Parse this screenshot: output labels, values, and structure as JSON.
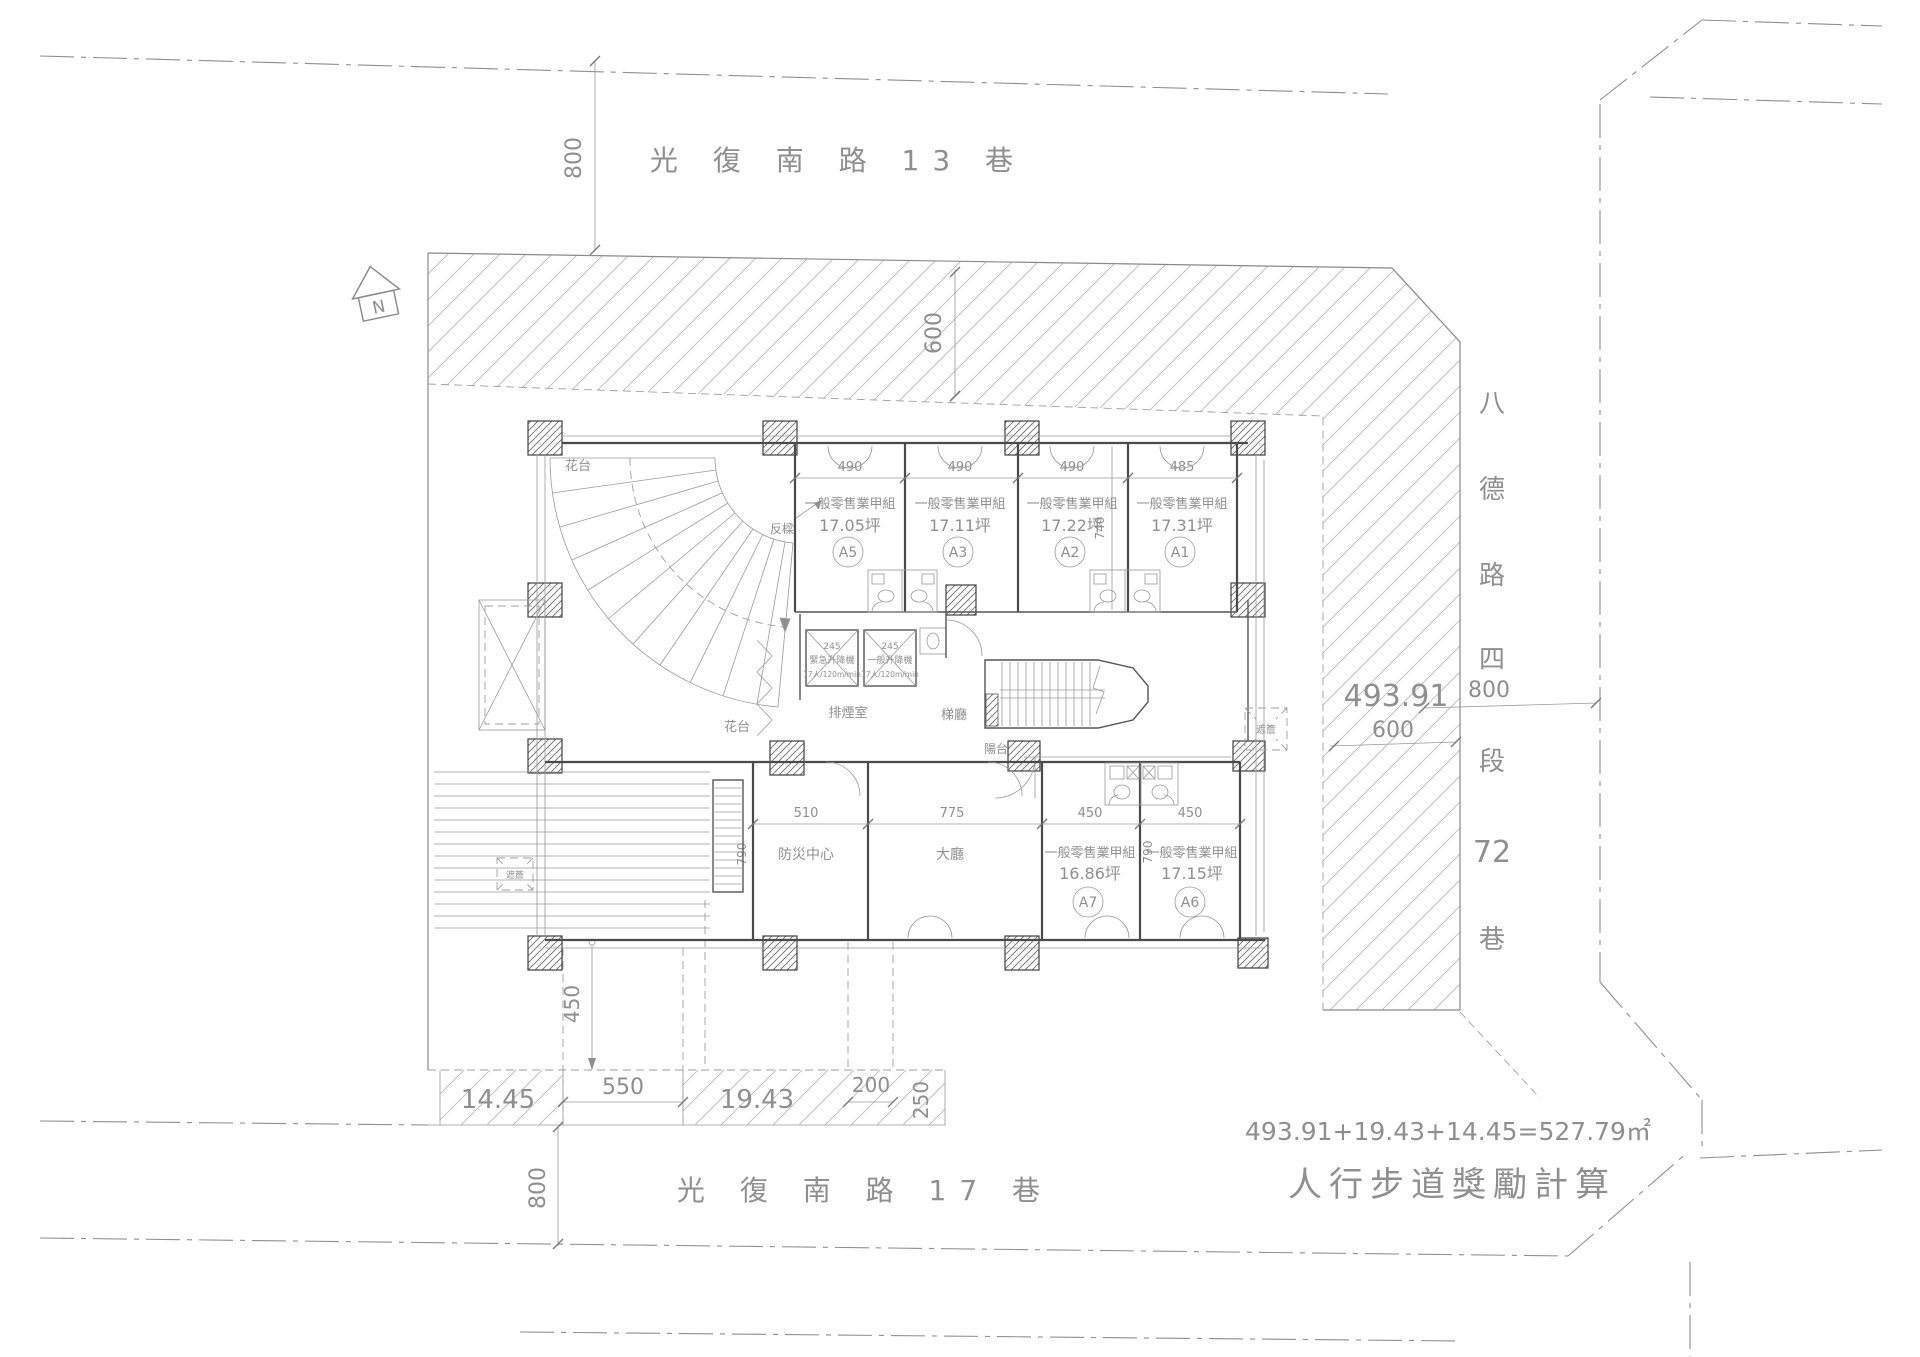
{
  "north": {
    "label": "N"
  },
  "streets": {
    "top": {
      "name": "光 復 南 路 13 巷",
      "width_dim": "800"
    },
    "bottom": {
      "name": "光 復 南 路 17 巷",
      "width_dim": "800"
    },
    "right": {
      "chars": [
        "八",
        "德",
        "路",
        "四",
        "段",
        "72",
        "巷"
      ],
      "width_dim": "800"
    }
  },
  "site": {
    "area_right": "493.91",
    "setback_right": "600",
    "setback_top": "600",
    "sidewalk_segments": {
      "left": "14.45",
      "walkway": "550",
      "mid": "19.43",
      "dim_200": "200",
      "dim_250": "250",
      "dim_450": "450"
    }
  },
  "units": {
    "top_row_dims": [
      "490",
      "490",
      "490",
      "485"
    ],
    "top_row_depth": "740",
    "bottom_dims": {
      "fangzai": "510",
      "dating": "775",
      "a7": "450",
      "a6": "450",
      "depth_left": "790",
      "depth_right": "790"
    },
    "list": [
      {
        "id": "A5",
        "type": "一般零售業甲組",
        "area": "17.05坪"
      },
      {
        "id": "A3",
        "type": "一般零售業甲組",
        "area": "17.11坪"
      },
      {
        "id": "A2",
        "type": "一般零售業甲組",
        "area": "17.22坪"
      },
      {
        "id": "A1",
        "type": "一般零售業甲組",
        "area": "17.31坪"
      },
      {
        "id": "A7",
        "type": "一般零售業甲組",
        "area": "16.86坪"
      },
      {
        "id": "A6",
        "type": "一般零售業甲組",
        "area": "17.15坪"
      }
    ]
  },
  "rooms": {
    "disaster_center": "防災中心",
    "lobby": "大廳",
    "smoke_room": "排煙室",
    "stair_hall": "梯廳",
    "balcony": "陽台",
    "planter_top": "花台",
    "planter_mid": "花台",
    "inverted_beam": "反樑",
    "canopy_right": "遮簷",
    "canopy_left": "遮簷"
  },
  "elevators": {
    "emergency": {
      "size": "245",
      "name": "緊急升降機",
      "spec": "17人/120m/min"
    },
    "general": {
      "size": "245",
      "name": "一般升降機",
      "spec": "17人/120m/min"
    }
  },
  "calc": {
    "formula": "493.91+19.43+14.45=527.79㎡",
    "label": "人行步道獎勵計算"
  }
}
